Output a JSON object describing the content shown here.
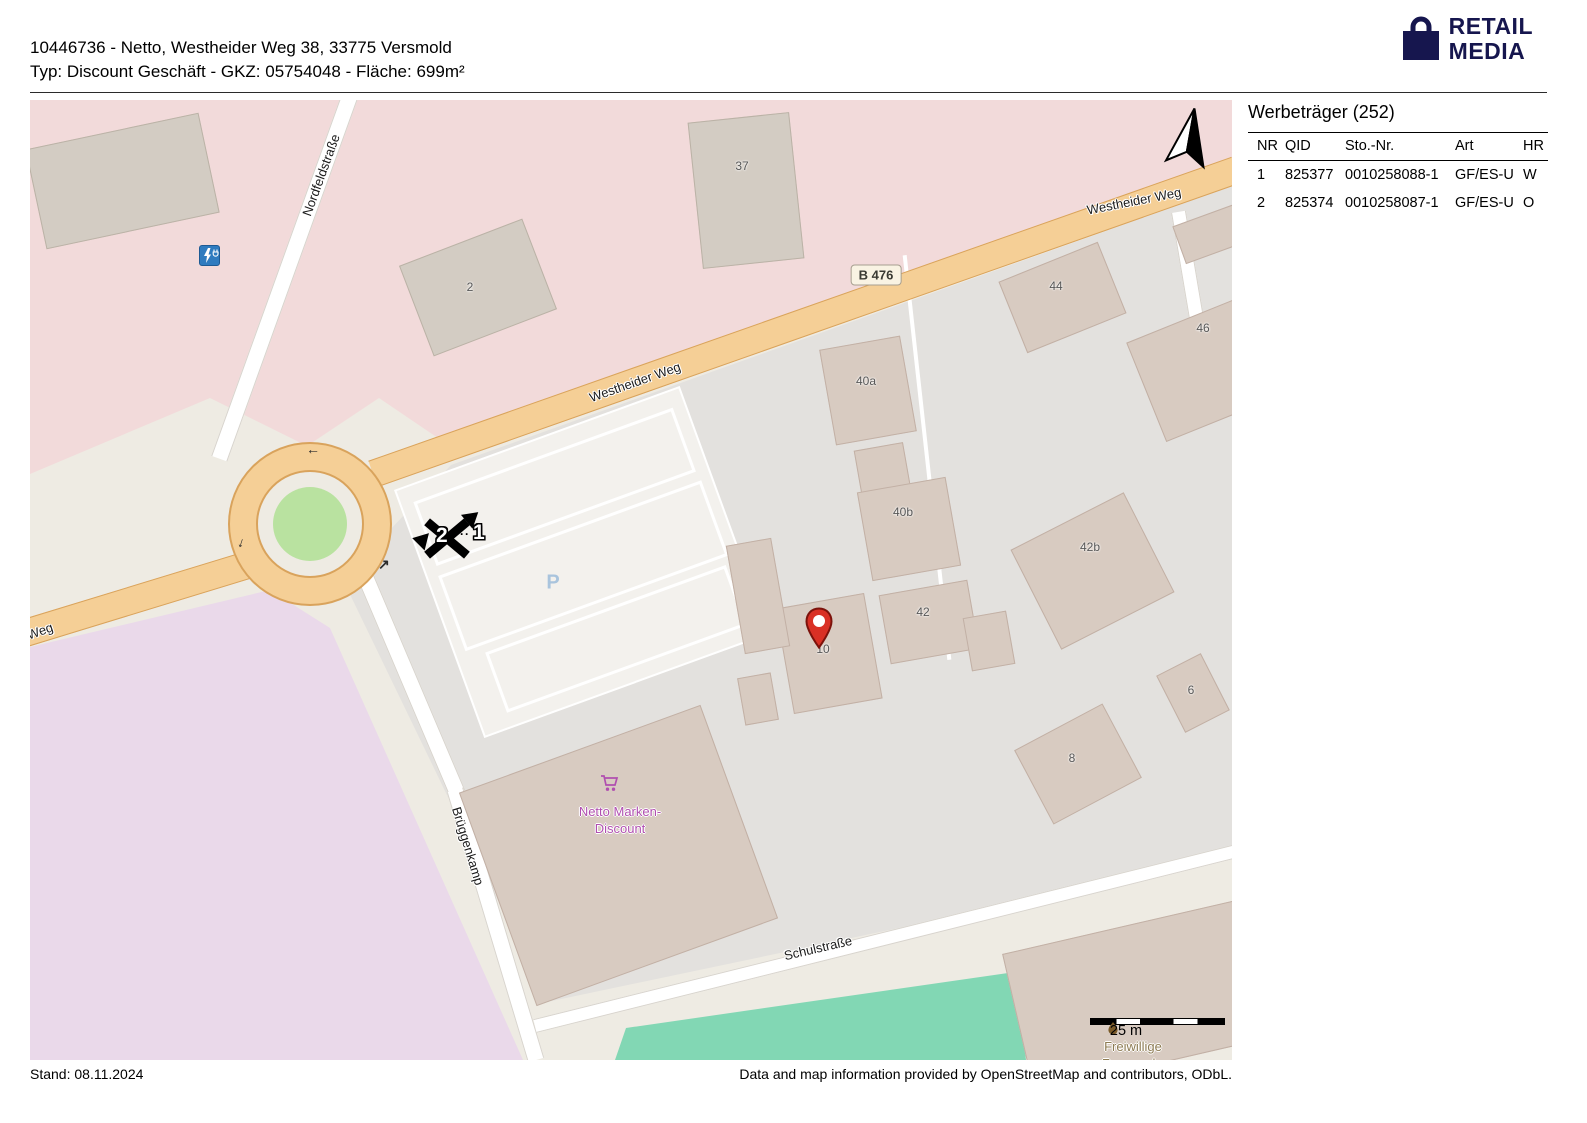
{
  "header": {
    "line1": "10446736 - Netto, Westheider Weg 38, 33775 Versmold",
    "line2": "Typ: Discount Geschäft - GKZ: 05754048 - Fläche: 699m²"
  },
  "logo": {
    "line1": "RETAIL",
    "line2": "MEDIA",
    "brand_color": "#16164e"
  },
  "panel": {
    "title": "Werbeträger (252)",
    "columns": {
      "nr": "NR",
      "qid": "QID",
      "sto": "Sto.-Nr.",
      "art": "Art",
      "hr": "HR"
    },
    "rows": [
      {
        "nr": "1",
        "qid": "825377",
        "sto": "0010258088-1",
        "art": "GF/ES-U",
        "hr": "W"
      },
      {
        "nr": "2",
        "qid": "825374",
        "sto": "0010258087-1",
        "art": "GF/ES-U",
        "hr": "O"
      }
    ]
  },
  "map": {
    "streets": {
      "westheider_a": "Westheider Weg",
      "westheider_b": "Westheider Weg",
      "nordfeldstrasse": "Nordfeldstraße",
      "brueggenkamp": "Brüggenkamp",
      "schulstrasse": "Schulstraße",
      "weg": "Weg"
    },
    "road_badge": "B 476",
    "parking_label": "P",
    "buildings": {
      "b2": "2",
      "b37": "37",
      "b44": "44",
      "b46": "46",
      "b40a": "40a",
      "b40b": "40b",
      "b42b": "42b",
      "b42": "42",
      "b10": "10",
      "b6": "6",
      "b8": "8"
    },
    "pois": {
      "netto_line1": "Netto Marken-",
      "netto_line2": "Discount",
      "feuerwehr_line1": "Freiwillige",
      "feuerwehr_line2": "Feuerwehr"
    },
    "markers": {
      "m1": "1",
      "m2": "2",
      "dots": "···"
    },
    "roundabout_arrows": {
      "top": "←",
      "left": "↓",
      "right": "↗"
    },
    "scale_label": "25 m",
    "colors": {
      "road_primary": "#f5cf96",
      "residential_pink": "#f2dada",
      "commercial_grey": "#e3e1de",
      "retail_purple": "#ead9ea",
      "pitch_green": "#82d7b4",
      "building_tan": "#d8cbc1",
      "netto_label": "#b04fb0",
      "pin_red": "#d93025"
    }
  },
  "footer": {
    "left": "Stand: 08.11.2024",
    "right": "Data and map information provided by OpenStreetMap and contributors, ODbL."
  }
}
